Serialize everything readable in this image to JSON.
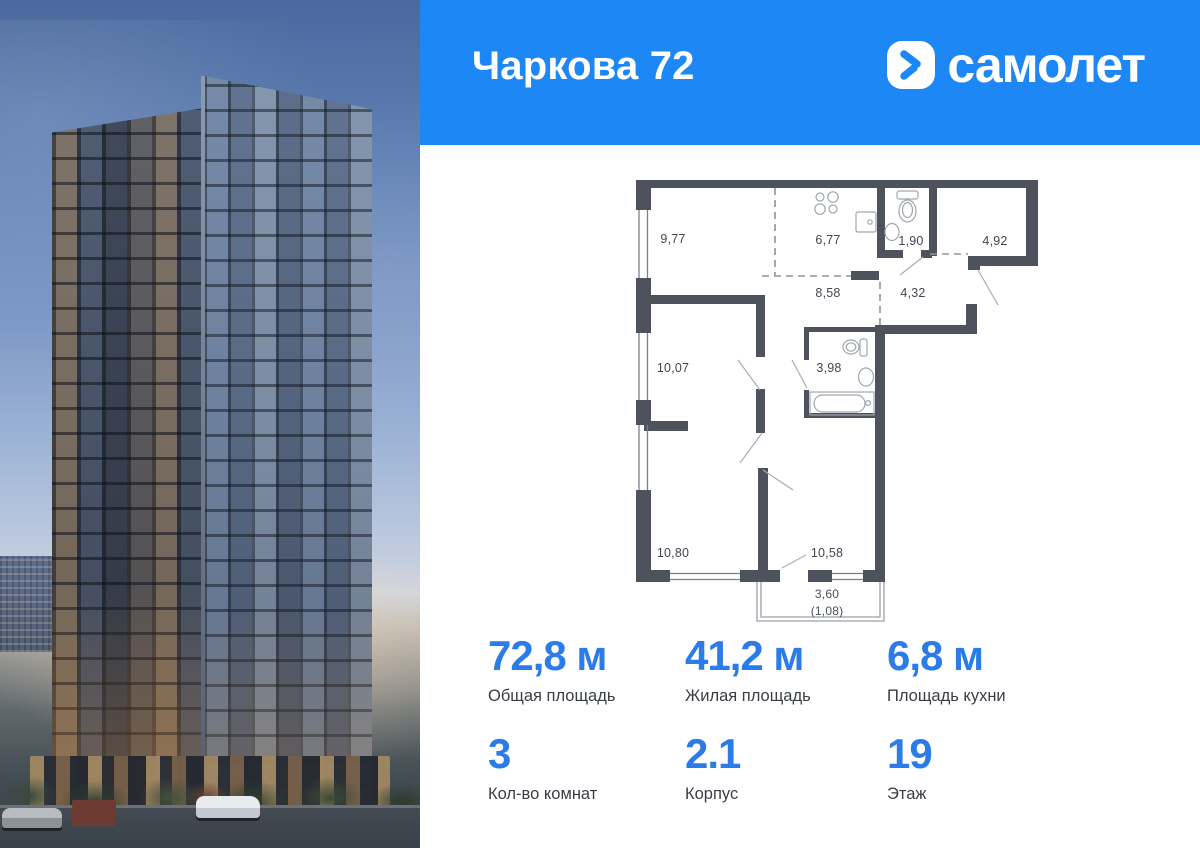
{
  "header": {
    "title": "Чаркова 72",
    "brand": "самолет"
  },
  "colors": {
    "header_blue": "#1e87f6",
    "stat_blue": "#2b7ce9",
    "plan_wall": "#4d525c"
  },
  "floor_plan": {
    "rooms": [
      {
        "name": "bedroom-1",
        "area": "9,77"
      },
      {
        "name": "kitchen",
        "area": "6,77"
      },
      {
        "name": "wc",
        "area": "1,90"
      },
      {
        "name": "entry-room",
        "area": "4,92"
      },
      {
        "name": "hallway",
        "area": "8,58"
      },
      {
        "name": "entry-hall",
        "area": "4,32"
      },
      {
        "name": "bedroom-2",
        "area": "10,07"
      },
      {
        "name": "bathroom",
        "area": "3,98"
      },
      {
        "name": "bedroom-3",
        "area": "10,80"
      },
      {
        "name": "living-room",
        "area": "10,58"
      },
      {
        "name": "balcony",
        "area": "3,60",
        "area_reduced": "(1,08)"
      }
    ]
  },
  "stats": {
    "items": [
      {
        "value": "72,8 м",
        "label": "Общая площадь"
      },
      {
        "value": "41,2 м",
        "label": "Жилая площадь"
      },
      {
        "value": "6,8 м",
        "label": "Площадь кухни"
      },
      {
        "value": "3",
        "label": "Кол-во комнат"
      },
      {
        "value": "2.1",
        "label": "Корпус"
      },
      {
        "value": "19",
        "label": "Этаж"
      }
    ]
  }
}
